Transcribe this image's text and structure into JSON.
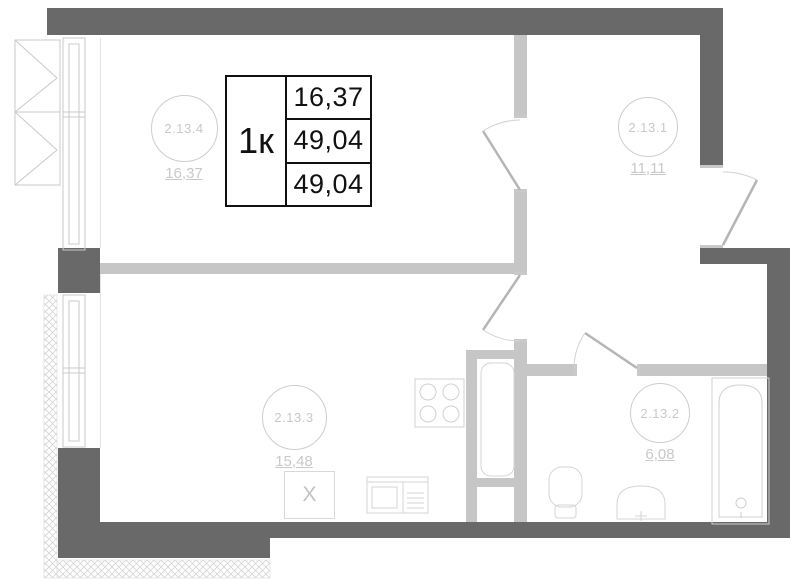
{
  "table": {
    "type_label": "1к",
    "living_area": "16,37",
    "total_area": "49,04",
    "total_area_with_balcony": "49,04"
  },
  "rooms": [
    {
      "name": "living-room",
      "number": "2.13.4",
      "area": "16,37"
    },
    {
      "name": "kitchen-living",
      "number": "2.13.3",
      "area": "15,48"
    },
    {
      "name": "hallway",
      "number": "2.13.1",
      "area": "11,11"
    },
    {
      "name": "bathroom",
      "number": "2.13.2",
      "area": "6,08"
    }
  ],
  "fixtures": {
    "washing_machine_label": "X"
  },
  "colors": {
    "outer_wall": "#696969",
    "inner_wall": "#c6c6c6",
    "fixture_line": "#d4d4d4",
    "label_text": "#c9c9c9",
    "table_border": "#111111"
  }
}
